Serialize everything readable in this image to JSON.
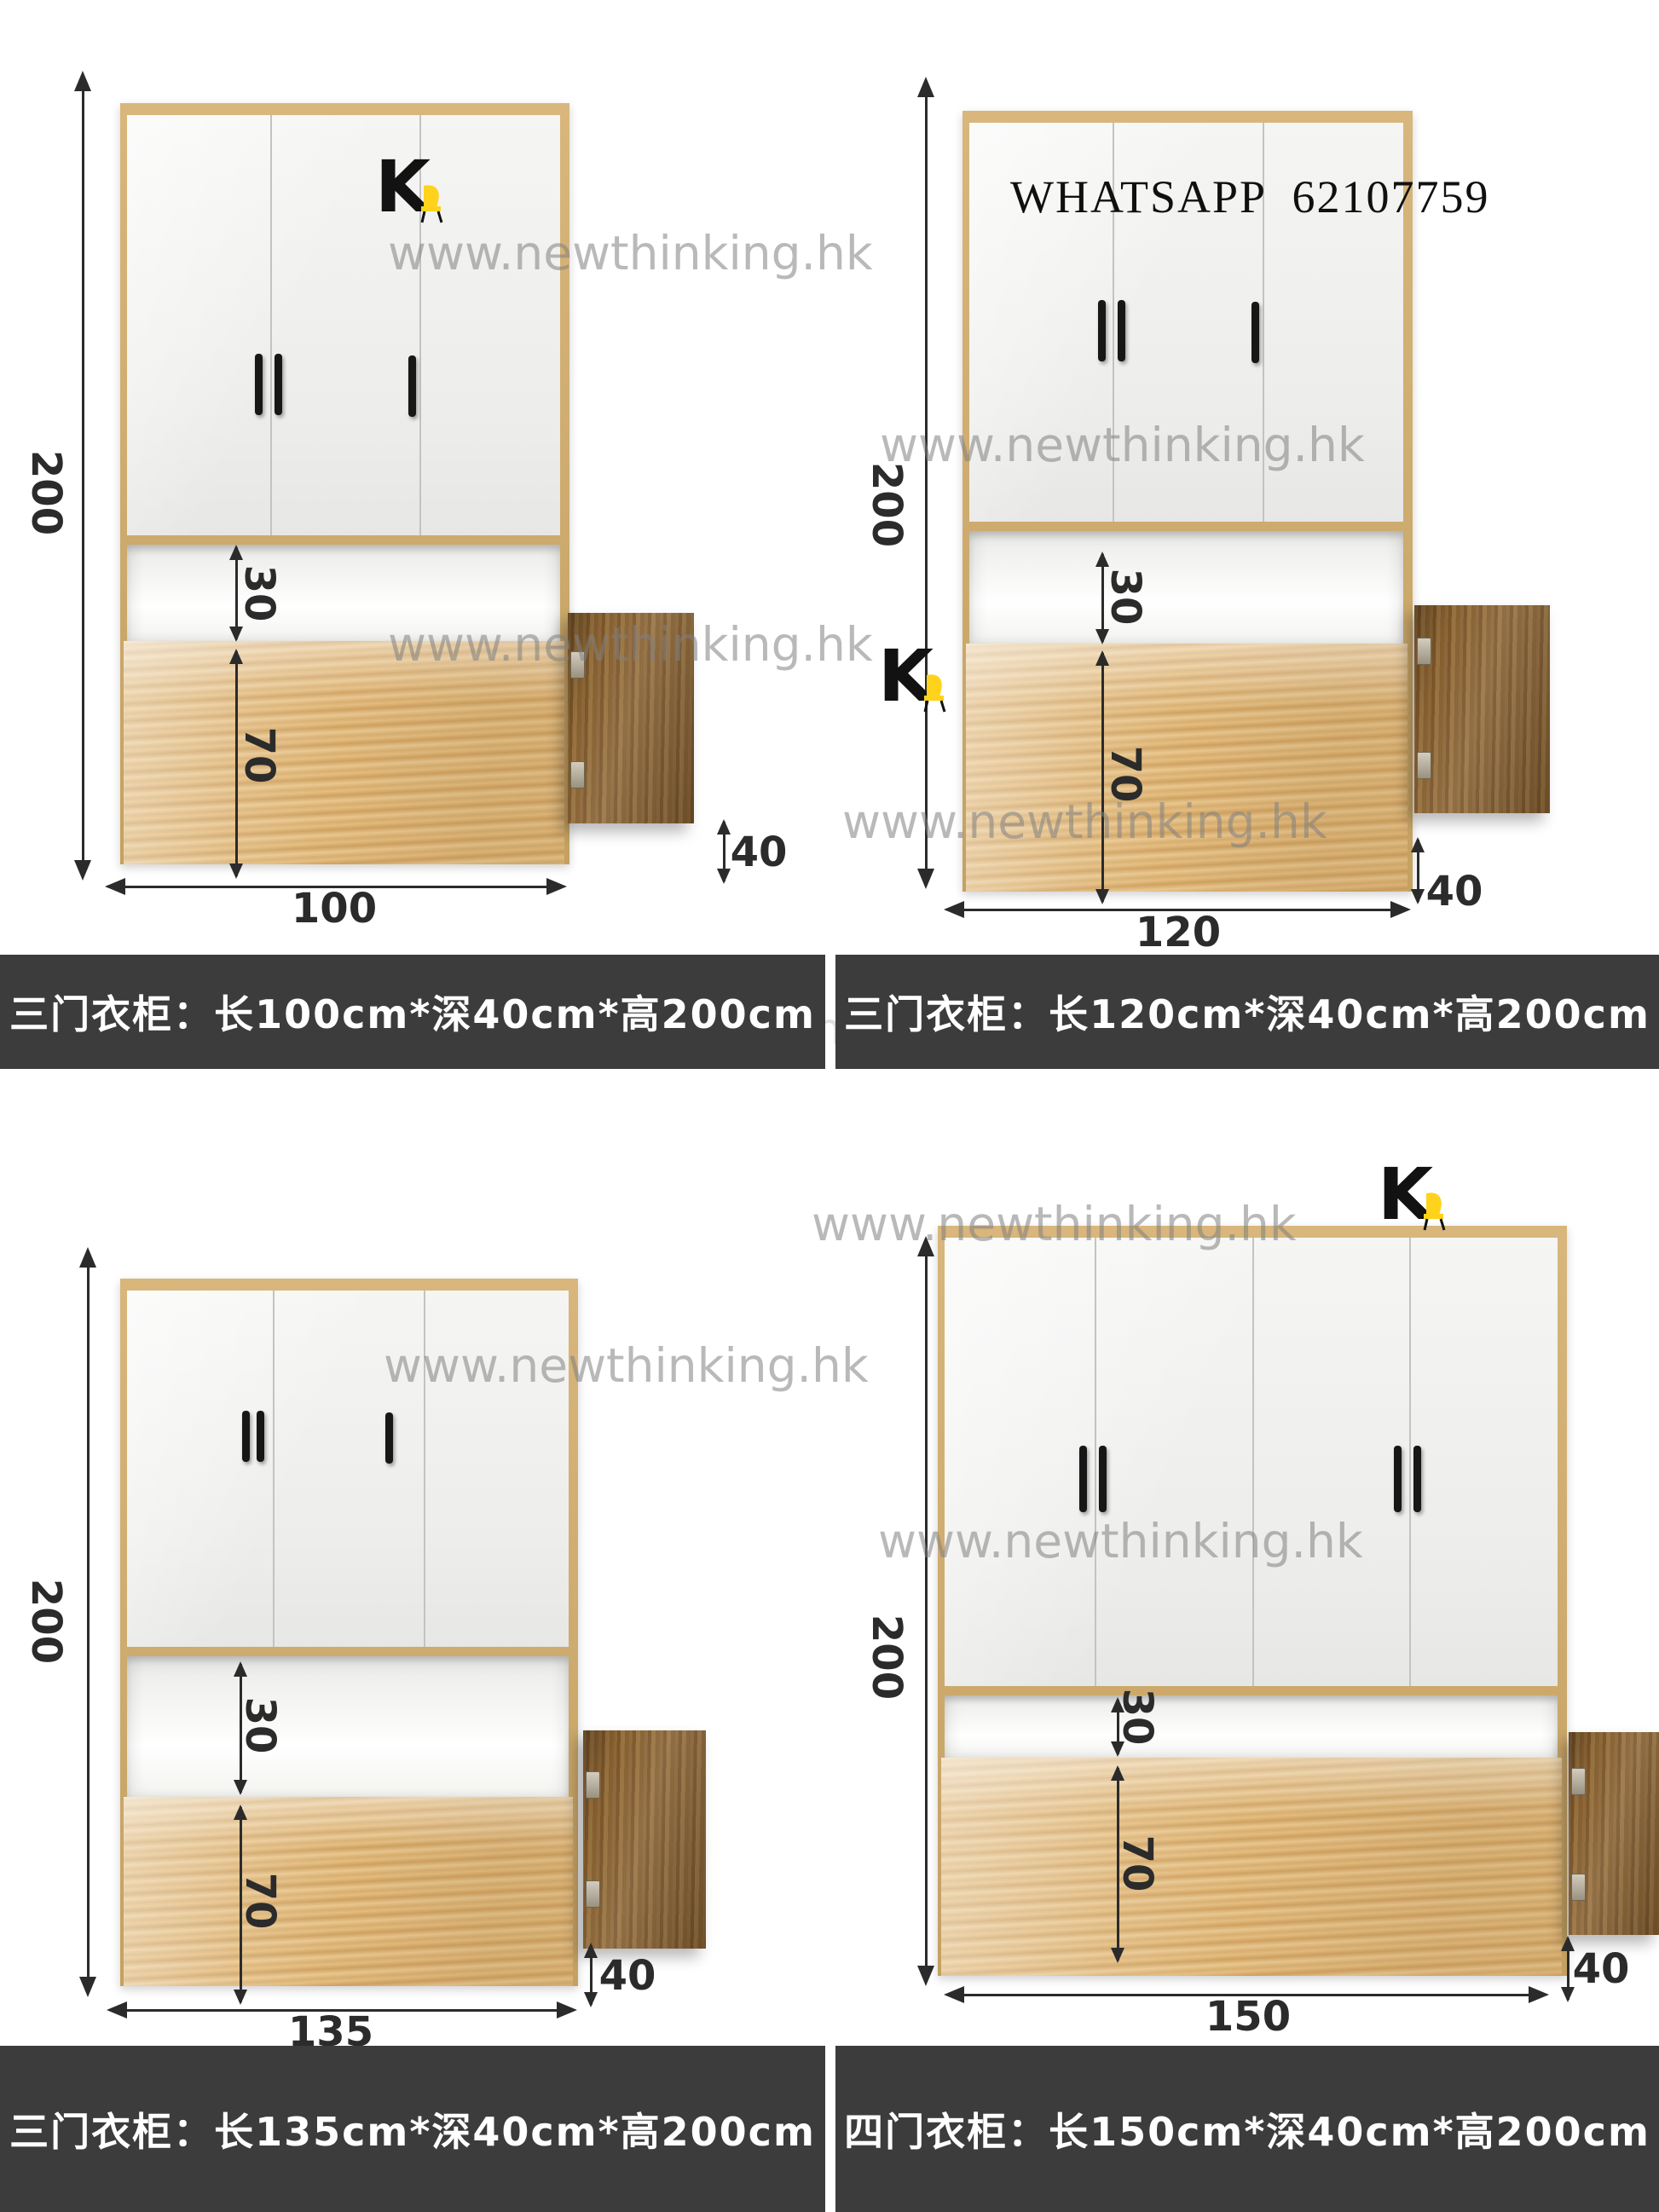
{
  "branding": {
    "watermark_text": "www.newthinking.hk",
    "logo_letter": "K",
    "whatsapp_label": "WHATSAPP 62107759"
  },
  "colors": {
    "accent_gold": "#c7a567",
    "caption_bg": "#3c3c3c",
    "caption_text": "#ffffff",
    "logo_yellow": "#ffd21c",
    "dimension_ink": "#2b2b2b",
    "watermark_gray": "#7f7f7f"
  },
  "quadrants": [
    {
      "name": "three-door-wardrobe-100",
      "caption": "三门衣柜：长100cm*深40cm*高200cm",
      "door_count": 3,
      "dims": {
        "height": "200",
        "shelf": "30",
        "lower": "70",
        "width": "100",
        "depth": "40"
      }
    },
    {
      "name": "three-door-wardrobe-120",
      "caption": "三门衣柜：长120cm*深40cm*高200cm",
      "door_count": 3,
      "dims": {
        "height": "200",
        "shelf": "30",
        "lower": "70",
        "width": "120",
        "depth": "40"
      }
    },
    {
      "name": "three-door-wardrobe-135",
      "caption": "三门衣柜：长135cm*深40cm*高200cm",
      "door_count": 3,
      "dims": {
        "height": "200",
        "shelf": "30",
        "lower": "70",
        "width": "135",
        "depth": "40"
      }
    },
    {
      "name": "four-door-wardrobe-150",
      "caption": "四门衣柜：长150cm*深40cm*高200cm",
      "door_count": 4,
      "dims": {
        "height": "200",
        "shelf": "30",
        "lower": "70",
        "width": "150",
        "depth": "40"
      }
    }
  ]
}
